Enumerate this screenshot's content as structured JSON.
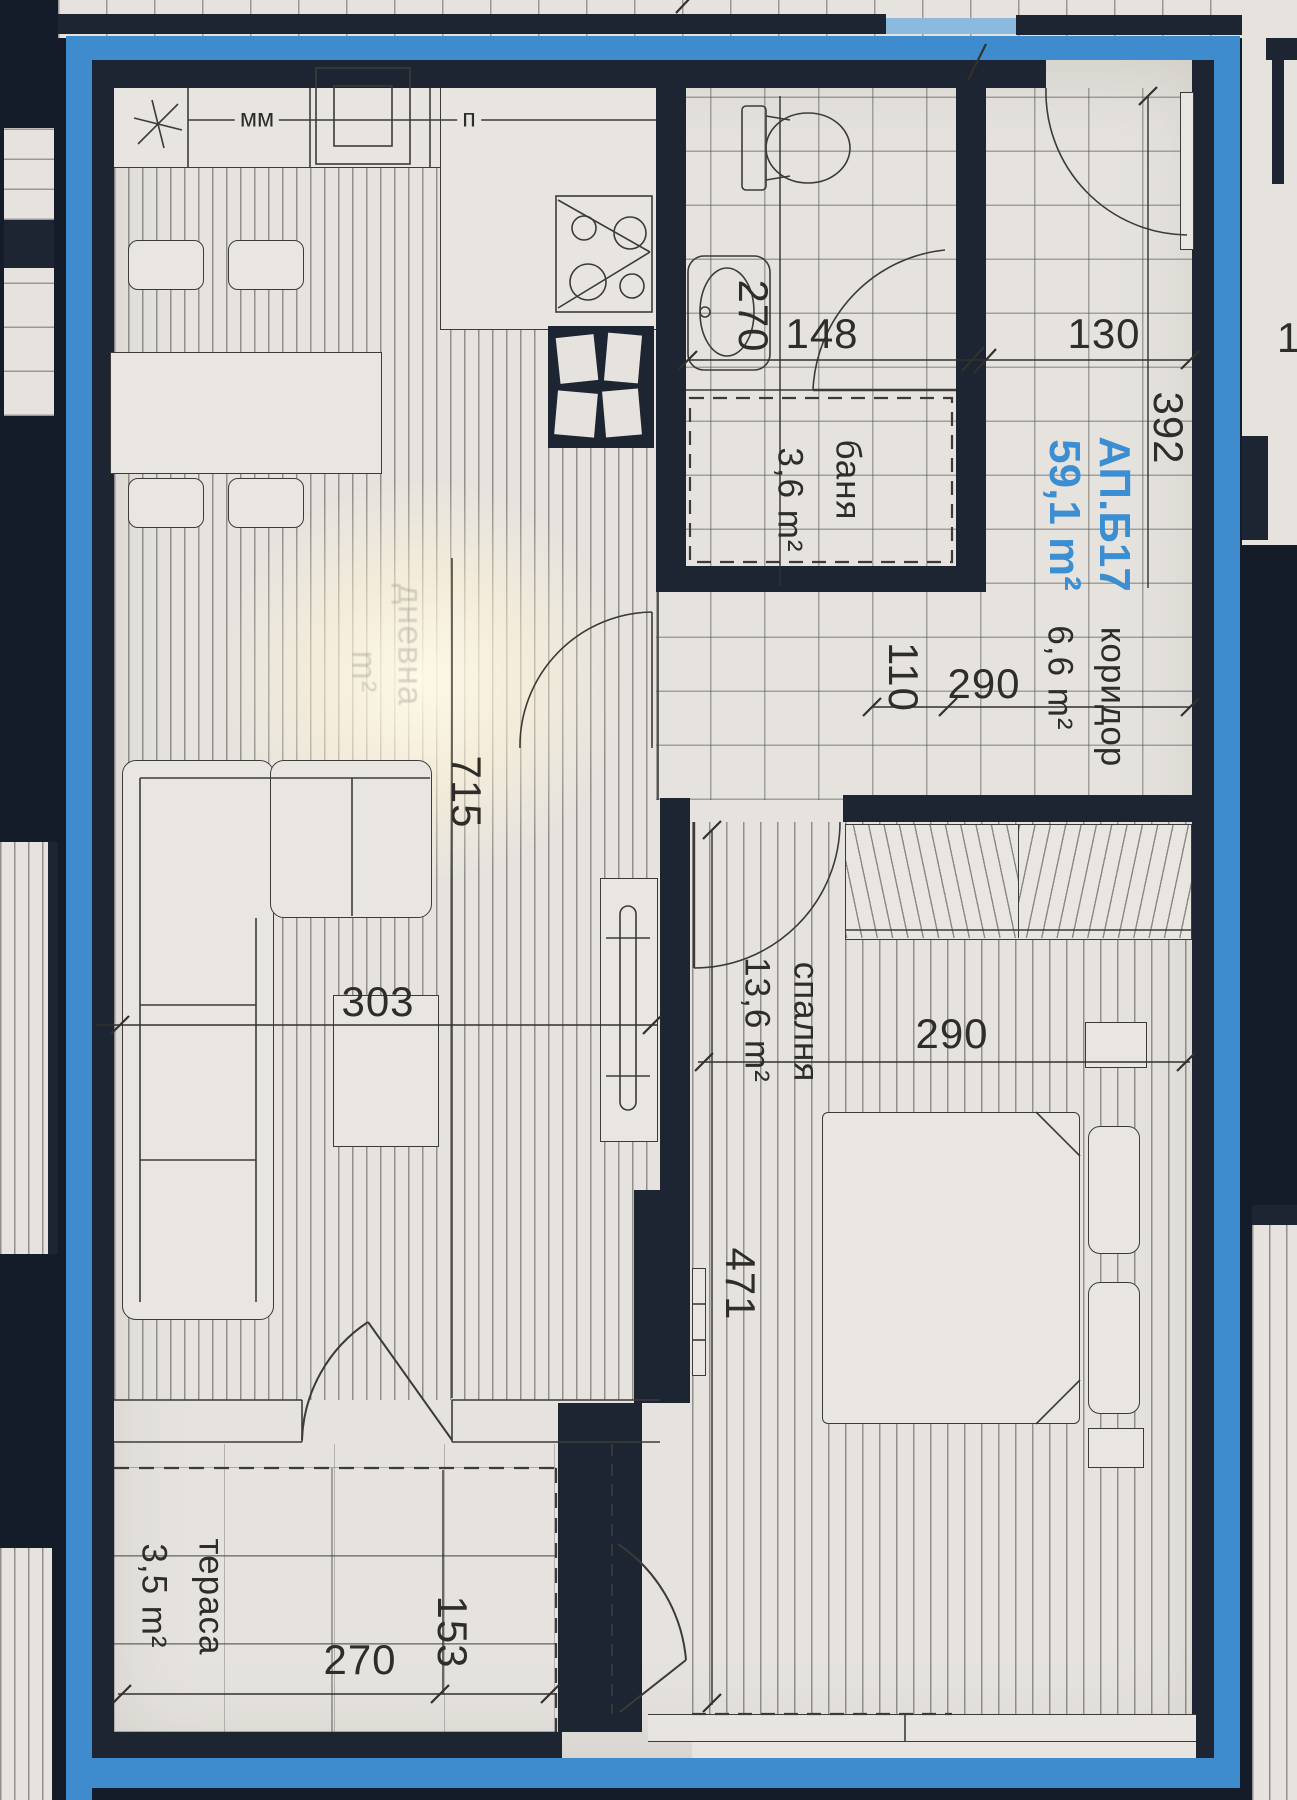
{
  "title": {
    "apartment": "АП.Б17",
    "total_area": "59,1 m²"
  },
  "rooms": {
    "corridor": {
      "name": "коридор",
      "area": "6,6 m²"
    },
    "bathroom": {
      "name": "баня",
      "area": "3,6 m²"
    },
    "bedroom": {
      "name": "спалня",
      "area": "13,6 m²"
    },
    "terrace": {
      "name": "тераса",
      "area": "3,5 m²"
    },
    "living": {
      "name": "дневна",
      "area": "m²"
    }
  },
  "dimensions": {
    "bath_height": "270",
    "bath_width": "148",
    "entrance_width": "130",
    "corridor_length": "392",
    "door_offset": "110",
    "corridor_width": "290",
    "living_length": "715",
    "living_width": "303",
    "bedroom_width": "290",
    "bedroom_length": "471",
    "terrace_depth": "153",
    "terrace_width": "270",
    "right_edge_partial": "1"
  },
  "kitchen_labels": {
    "mm": "мм",
    "p": "п"
  },
  "colors": {
    "accent_blue": "#3b8ed2",
    "frame_blue": "#3e8bcd",
    "wall": "#1c2531",
    "paper": "#e6e3df"
  }
}
